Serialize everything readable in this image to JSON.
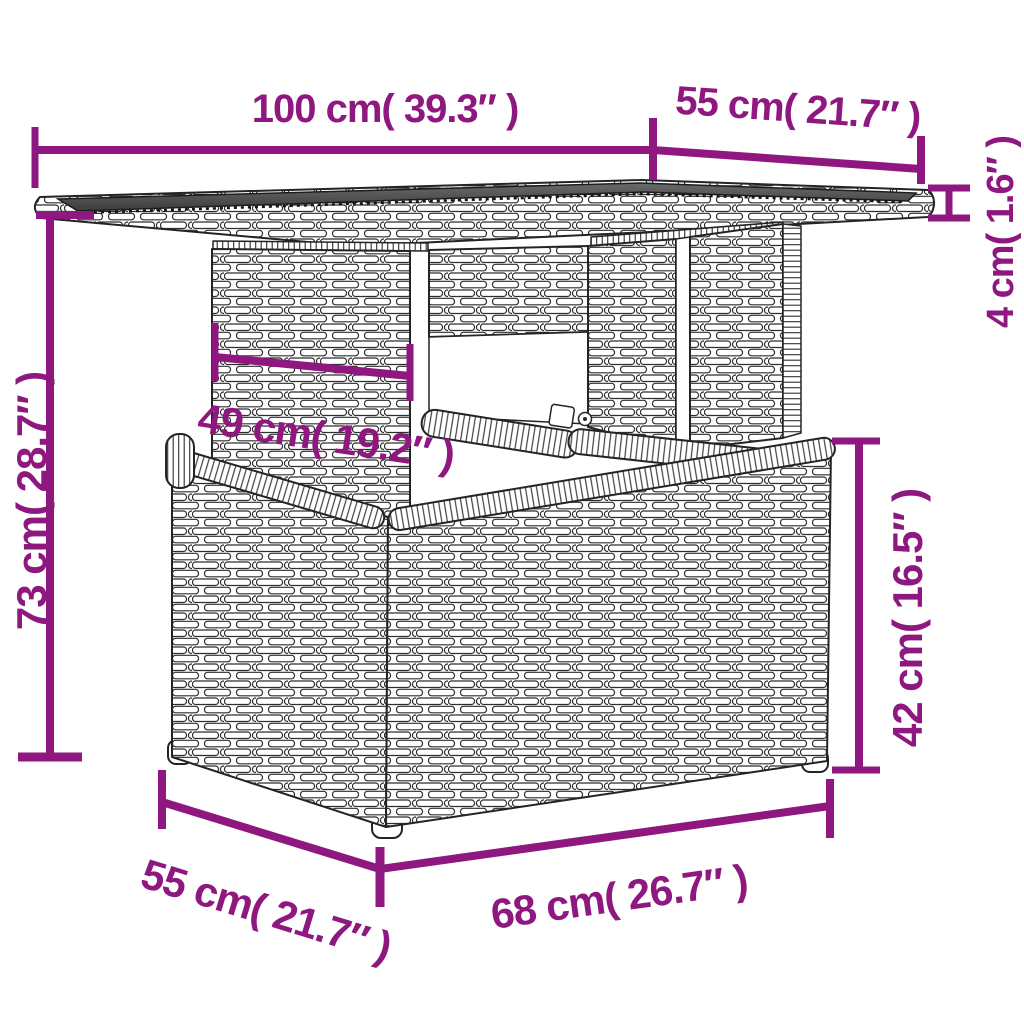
{
  "diagram": {
    "kind": "product-dimension-drawing",
    "subject": "poly rattan garden table with glass top, pedestal frame and storage base",
    "style": "black line art wicker texture on white with magenta dimension annotations"
  },
  "colors": {
    "dimension_accent": "#8e187f",
    "line_art": "#242424",
    "glass_top": "#4a4a4a",
    "background": "#ffffff"
  },
  "dims": {
    "tabletop_width": "100 cm( 39.3″ )",
    "tabletop_depth": "55 cm( 21.7″ )",
    "tabletop_thickness": "4 cm( 1.6″ )",
    "total_height": "73 cm( 28.7″ )",
    "pedestal_width": "49 cm( 19.2″ )",
    "base_height": "42 cm( 16.5″ )",
    "base_depth": "55 cm( 21.7″ )",
    "base_width": "68 cm( 26.7″ )"
  }
}
